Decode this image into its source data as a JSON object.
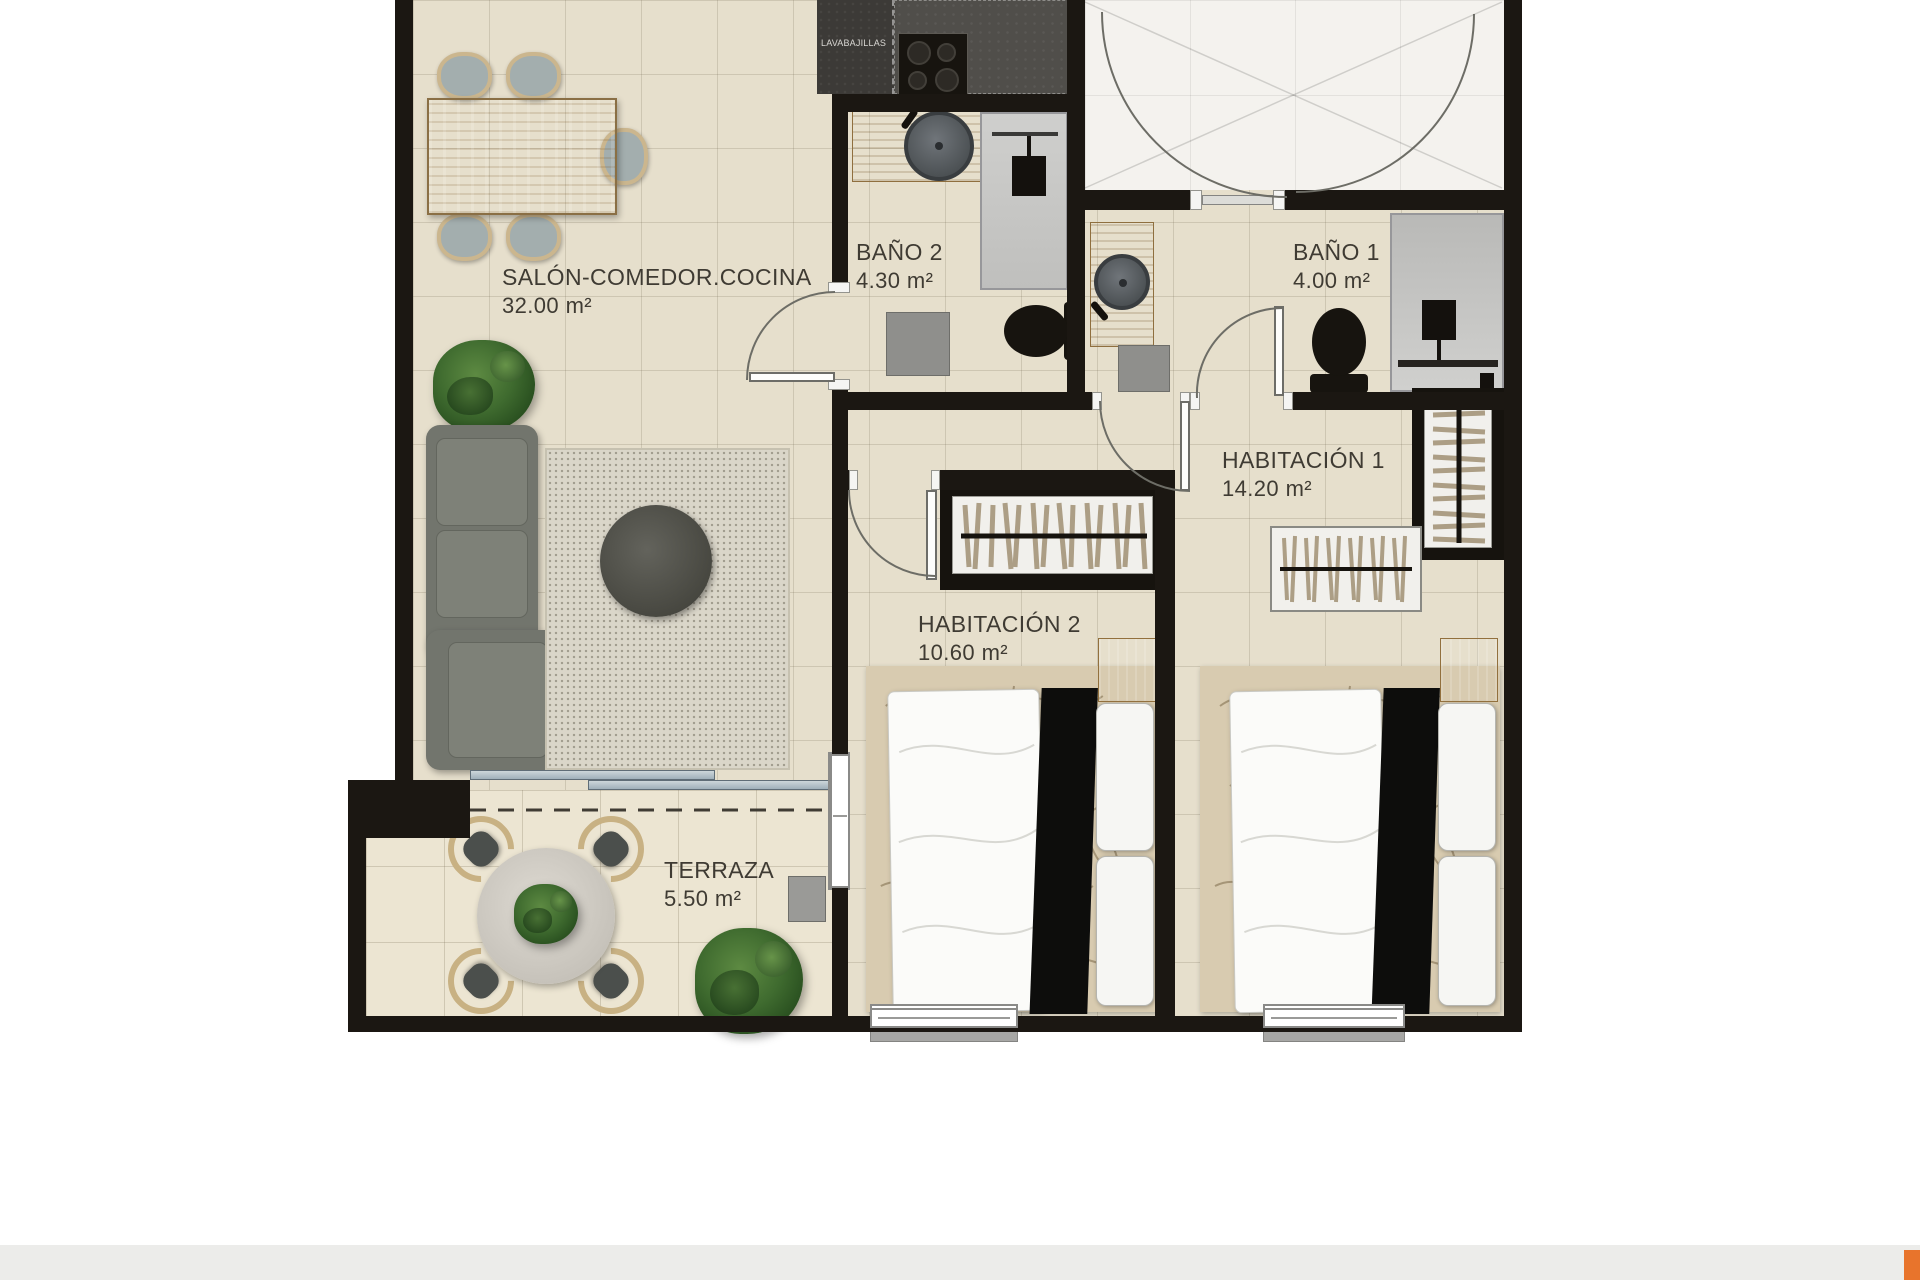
{
  "plan": {
    "title": "apartment-floor-plan",
    "rooms": [
      {
        "name": "SALÓN-COMEDOR.COCINA",
        "area": "32.00 m²"
      },
      {
        "name": "BAÑO 2",
        "area": "4.30 m²"
      },
      {
        "name": "BAÑO 1",
        "area": "4.00 m²"
      },
      {
        "name": "HABITACIÓN 1",
        "area": "14.20 m²"
      },
      {
        "name": "HABITACIÓN 2",
        "area": "10.60 m²"
      },
      {
        "name": "TERRAZA",
        "area": "5.50 m²"
      }
    ],
    "appliances": {
      "dishwasher_label": "LAVABAJILLAS"
    },
    "colors": {
      "wall": "#1b1712",
      "floor": "#e6dfcc",
      "entry_floor": "#f4f2ee",
      "terrace_floor": "#ece5d2",
      "wood": "#c9a36b",
      "sofa": "#72756d",
      "logo_accent": "#e8742c"
    }
  }
}
